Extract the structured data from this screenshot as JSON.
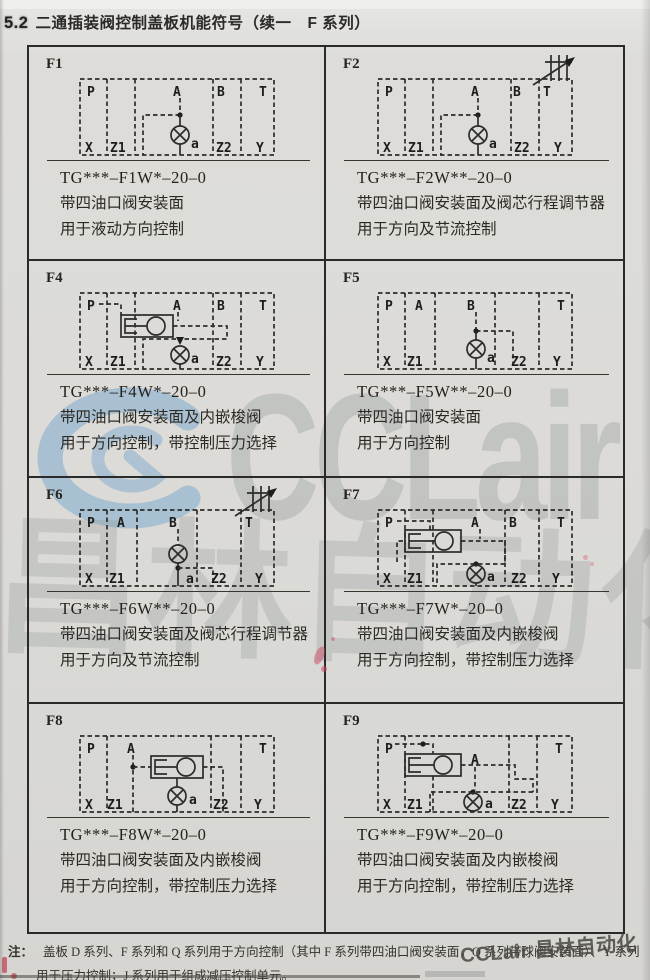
{
  "page": {
    "heading_number": "5.2",
    "heading_title": "二通插装阀控制盖板机能符号（续一　F 系列）",
    "note_label": "注：",
    "note_line1": "盖板 D 系列、F 系列和 Q 系列用于方向控制（其中 F 系列带四油口阀安装面，Q 系列带球阀安装面）、Y 系列",
    "note_line2": "用于压力控制；J 系列用于组成减压控制单元。",
    "watermark_center": {
      "logo": "C",
      "text": "CCLair",
      "cjk": "昌林自动化"
    },
    "watermark_corner": "CCLair 昌林自动化",
    "colors": {
      "paper": "#dcdbd7",
      "ink": "#2e2d2b",
      "table_border": "#2a2a28",
      "watermark_blue": "#73a5cd",
      "watermark_gray": "#969c9a",
      "mark_pink": "#cd4664"
    }
  },
  "cells": [
    {
      "id": "F1",
      "model": "TG***–F1W*–20–0",
      "desc1": "带四油口阀安装面",
      "desc2": "用于液动方向控制",
      "valve_label": "a",
      "ports": {
        "p": "P",
        "a": "A",
        "b": "B",
        "t": "T",
        "x": "X",
        "z1": "Z1",
        "z2": "Z2",
        "y": "Y"
      }
    },
    {
      "id": "F2",
      "model": "TG***–F2W**–20–0",
      "desc1": "带四油口阀安装面及阀芯行程调节器",
      "desc2": "用于方向及节流控制",
      "valve_label": "a",
      "ports": {
        "p": "P",
        "a": "A",
        "b": "B",
        "t": "T",
        "x": "X",
        "z1": "Z1",
        "z2": "Z2",
        "y": "Y"
      }
    },
    {
      "id": "F4",
      "model": "TG***–F4W*–20–0",
      "desc1": "带四油口阀安装面及内嵌梭阀",
      "desc2": "用于方向控制，带控制压力选择",
      "valve_label": "a",
      "ports": {
        "p": "P",
        "a": "A",
        "b": "B",
        "t": "T",
        "x": "X",
        "z1": "Z1",
        "z2": "Z2",
        "y": "Y"
      }
    },
    {
      "id": "F5",
      "model": "TG***–F5W**–20–0",
      "desc1": "带四油口阀安装面",
      "desc2": "用于方向控制",
      "valve_label": "a",
      "ports": {
        "p": "P",
        "a": "A",
        "b": "B",
        "t": "T",
        "x": "X",
        "z1": "Z1",
        "z2": "Z2",
        "y": "Y"
      }
    },
    {
      "id": "F6",
      "model": "TG***–F6W**–20–0",
      "desc1": "带四油口阀安装面及阀芯行程调节器",
      "desc2": "用于方向及节流控制",
      "valve_label": "a",
      "ports": {
        "p": "P",
        "a": "A",
        "b": "B",
        "t": "T",
        "x": "X",
        "z1": "Z1",
        "z2": "Z2",
        "y": "Y"
      }
    },
    {
      "id": "F7",
      "model": "TG***–F7W*–20–0",
      "desc1": "带四油口阀安装面及内嵌梭阀",
      "desc2": "用于方向控制，带控制压力选择",
      "valve_label": "a",
      "ports": {
        "p": "P",
        "a": "A",
        "b": "B",
        "t": "T",
        "x": "X",
        "z1": "Z1",
        "z2": "Z2",
        "y": "Y"
      }
    },
    {
      "id": "F8",
      "model": "TG***–F8W*–20–0",
      "desc1": "带四油口阀安装面及内嵌梭阀",
      "desc2": "用于方向控制，带控制压力选择",
      "valve_label": "a",
      "ports": {
        "p": "P",
        "a": "A",
        "t": "T",
        "x": "X",
        "z1": "Z1",
        "z2": "Z2",
        "y": "Y"
      }
    },
    {
      "id": "F9",
      "model": "TG***–F9W*–20–0",
      "desc1": "带四油口阀安装面及内嵌梭阀",
      "desc2": "用于方向控制，带控制压力选择",
      "valve_label": "a",
      "ports": {
        "p": "P",
        "a": "A",
        "t": "T",
        "x": "X",
        "z1": "Z1",
        "z2": "Z2",
        "y": "Y"
      }
    }
  ]
}
